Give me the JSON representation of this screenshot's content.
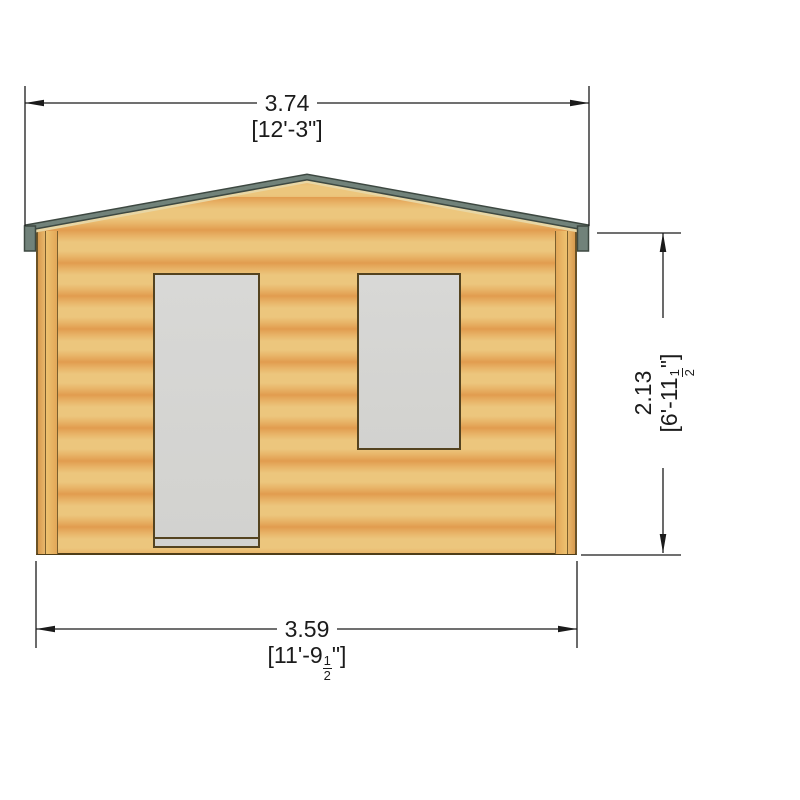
{
  "drawing": {
    "view": "Front elevation of log cabin with door and window"
  },
  "dimensions": {
    "top": {
      "metric": "3.74",
      "imperial": "[12'-3\"]"
    },
    "bottom": {
      "metric": "3.59",
      "imperial_prefix": "[11'-9",
      "imperial_fraction_numerator": "1",
      "imperial_fraction_denominator": "2",
      "imperial_suffix": "\"]"
    },
    "right": {
      "metric": "2.13",
      "imperial_prefix": "[6'-11",
      "imperial_fraction_numerator": "1",
      "imperial_fraction_denominator": "2",
      "imperial_suffix": "\"]"
    }
  },
  "colors": {
    "background": "#ffffff",
    "wood_light": "#ecc67d",
    "wood_dark": "#e19c4f",
    "wood_mid": "#e8b367",
    "roof_trim": "#71827a",
    "roof_trim_dark": "#3d4841",
    "fascia": "#e8d6a4",
    "frame_outline": "#54431f",
    "wall_outline": "#6b5226",
    "glass_gray": "#d6d6d3",
    "dimension_line": "#1b1b1b"
  }
}
